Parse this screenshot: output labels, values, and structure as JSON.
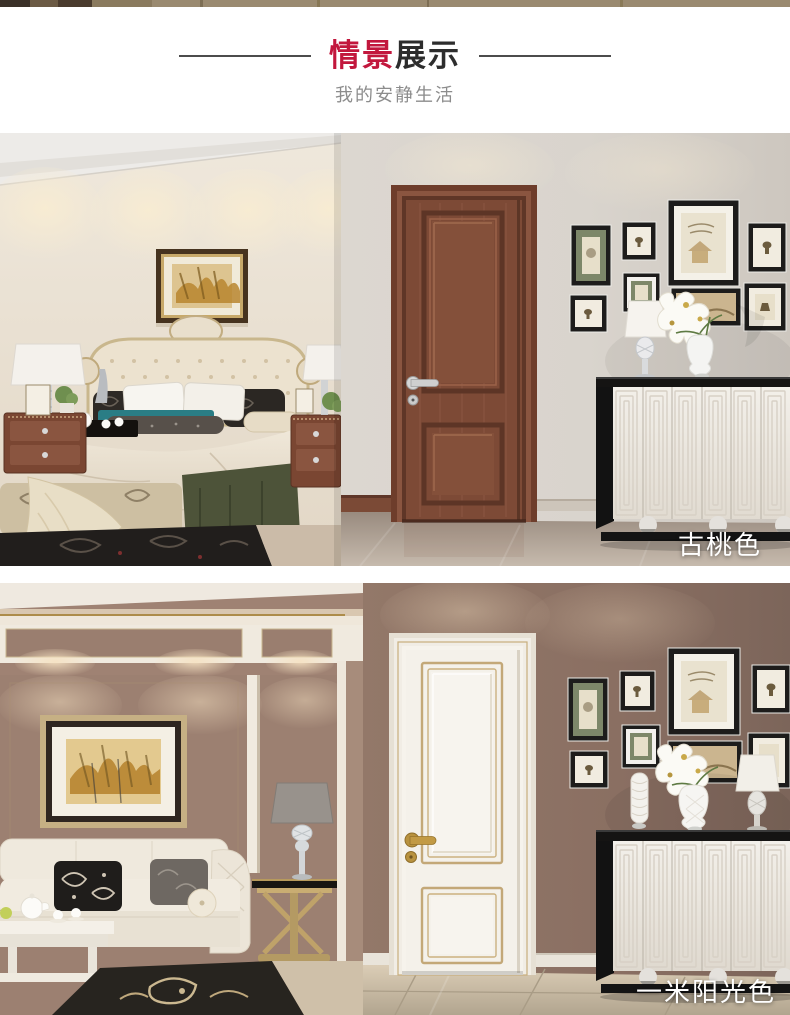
{
  "header": {
    "title_accent": "情景",
    "title_rest": "展示",
    "subtitle": "我的安静生活"
  },
  "photos": [
    {
      "label": "古桃色",
      "door_color": "#7d4a36",
      "door_panel_color": "#84503a",
      "door_trim_color": "#5d3526"
    },
    {
      "label": "一米阳光色",
      "door_color": "#f4f1ea",
      "door_panel_color": "#f7f4ee",
      "door_trim_color": "#c3a878"
    }
  ],
  "colors": {
    "accent": "#c2173d",
    "title_text": "#2d2d2d",
    "subtitle_text": "#8c8c8c",
    "label_text": "#ffffff"
  }
}
